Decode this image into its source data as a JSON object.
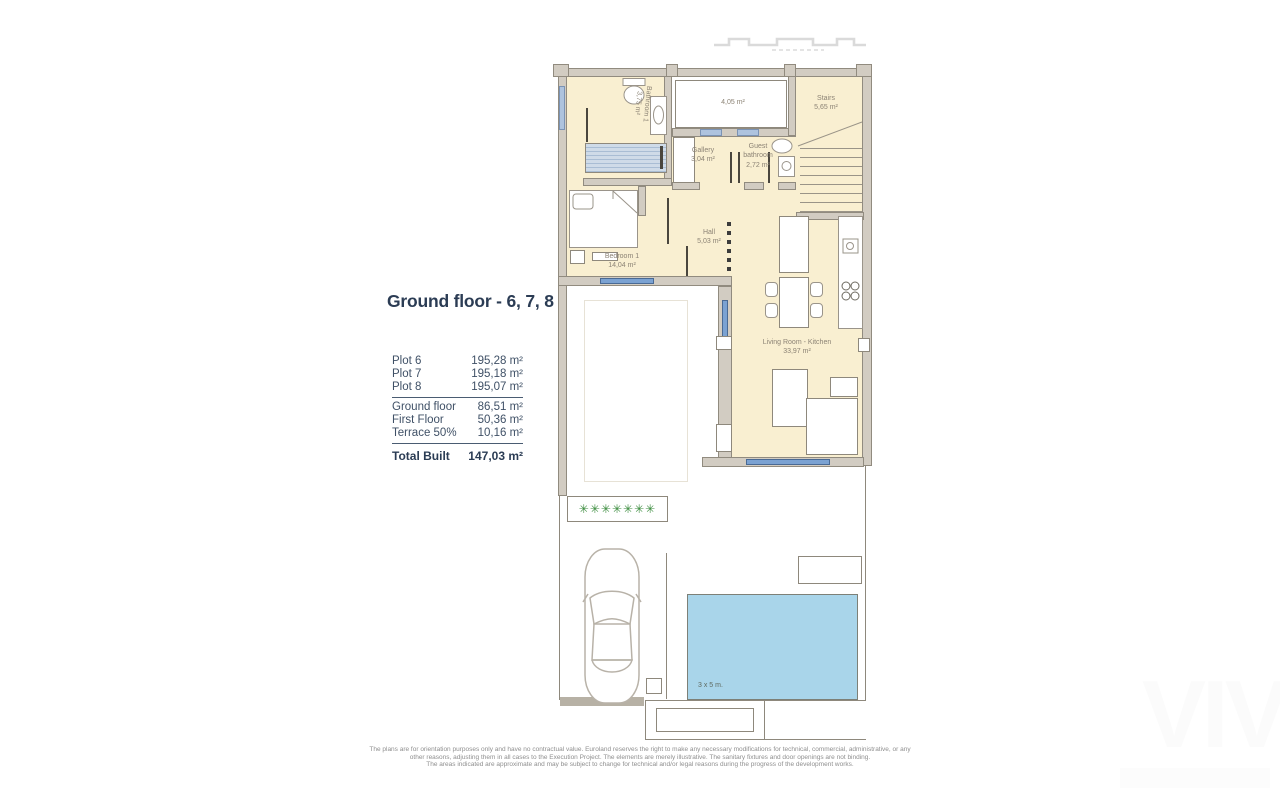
{
  "info_panel": {
    "title": "Ground floor - 6, 7, 8",
    "plots": [
      {
        "label": "Plot 6",
        "value": "195,28 m²"
      },
      {
        "label": "Plot 7",
        "value": "195,18 m²"
      },
      {
        "label": "Plot 8",
        "value": "195,07 m²"
      }
    ],
    "areas": [
      {
        "label": "Ground floor",
        "value": "86,51 m²"
      },
      {
        "label": "First Floor",
        "value": "50,36 m²"
      },
      {
        "label": "Terrace 50%",
        "value": "10,16 m²"
      }
    ],
    "total": {
      "label": "Total Built",
      "value": "147,03 m²"
    }
  },
  "floorplan": {
    "rooms": {
      "bathroom1": {
        "name": "Bathroom 1",
        "area": "3,75 m²"
      },
      "patio": {
        "area": "4,05 m²"
      },
      "stairs": {
        "name": "Stairs",
        "area": "5,65 m²"
      },
      "gallery": {
        "name": "Gallery",
        "area": "3,04 m²"
      },
      "guest_bathroom": {
        "name": "Guest bathroom",
        "area": "2,72 m²"
      },
      "hall": {
        "name": "Hall",
        "area": "5,03 m²"
      },
      "bedroom1": {
        "name": "Bedroom 1",
        "area": "14,04 m²"
      },
      "living_kitchen": {
        "name": "Living Room - Kitchen",
        "area": "33,97 m²"
      }
    },
    "pool_label": "3 x 5 m.",
    "colors": {
      "floor": "#f9efd1",
      "wall_fill": "#d2ccc2",
      "wall_line": "#8e887c",
      "window_blue": "#7ba2d2",
      "pool_blue": "#a9d5ea",
      "plant_green": "#3e8e41"
    }
  },
  "disclaimer": {
    "line1": "The plans are for orientation purposes only and have no contractual value. Euroland reserves the right to make any necessary modifications for technical, commercial, administrative, or any",
    "line2": "other reasons, adjusting them in all cases to the Execution Project. The elements are merely illustrative. The sanitary fixtures and door openings are not binding.",
    "line3": "The areas indicated are approximate and may be subject to change for technical and/or legal reasons during the progress of the development works."
  },
  "watermark": "VIV"
}
